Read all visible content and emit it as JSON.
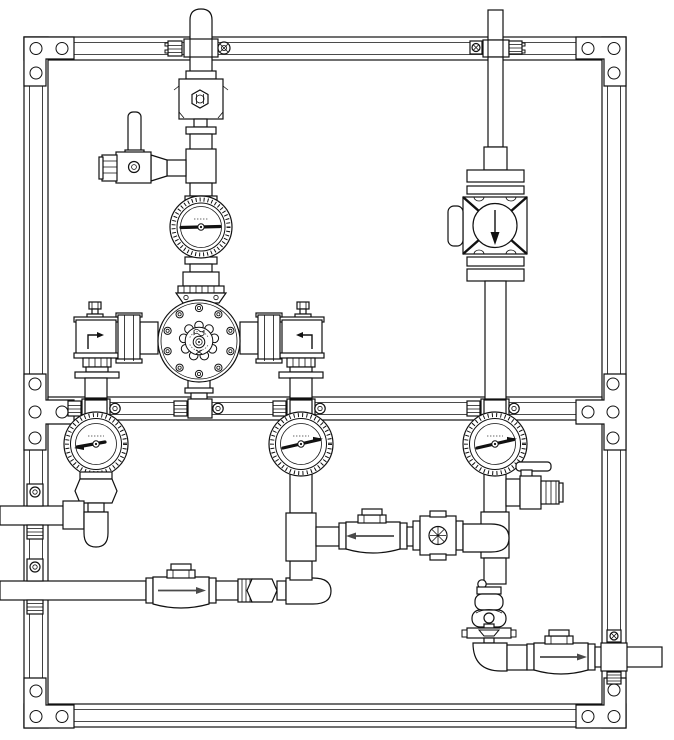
{
  "meta": {
    "title": "Piping assembly technical drawing (mixing valve station)",
    "canvas_width": 674,
    "canvas_height": 740
  },
  "style": {
    "background": "#ffffff",
    "line_color": "#111111",
    "flow_arrow_color": "#4a4a4a",
    "microtext_color": "#666666"
  },
  "frame": {
    "label": "Extruded aluminum mounting frame",
    "rails": [
      "top",
      "bottom",
      "left",
      "right",
      "middle"
    ],
    "corner_plates": [
      "top-left",
      "top-right",
      "bottom-left",
      "bottom-right"
    ],
    "junction_plates": [
      "middle-left",
      "middle-right"
    ],
    "holes_per_corner_plate": 3,
    "holes_per_junction_plate": 4
  },
  "components": {
    "left_riser": {
      "label": "Left inlet riser pipe (domed top, exits frame top)"
    },
    "relief_valve": {
      "label": "Pressure relief / reducing valve with hex bonnet"
    },
    "left_drain": {
      "label": "Test drain ball valve with lever handle and hose cap"
    },
    "thermometer": {
      "label": "Inline dial thermometer"
    },
    "regulator": {
      "label": "Round diaphragm regulator / thermostatic mixing valve with bolted flange and scalloped handwheel"
    },
    "left_angle_valve": {
      "label": "Left angle stop valve, flow arrow up-then-right"
    },
    "right_angle_valve": {
      "label": "Right angle stop valve, flow arrow up-then-left"
    },
    "union_left": {
      "label": "Pipe union, left of regulator"
    },
    "union_right": {
      "label": "Pipe union, right of regulator"
    },
    "right_riser": {
      "label": "Right riser pipe (exits frame top)"
    },
    "vertical_check": {
      "label": "Vertical check valve, flow arrow down"
    },
    "gauge_left": {
      "label": "Left pressure gauge"
    },
    "gauge_middle": {
      "label": "Middle pressure gauge"
    },
    "gauge_right": {
      "label": "Right pressure gauge"
    },
    "hex_fitting": {
      "label": "Hex adapter fitting below left gauge"
    },
    "left_upper_outlet": {
      "label": "Upper-left horizontal pipe, exits frame left"
    },
    "left_lower_inlet": {
      "label": "Lower-left horizontal pipe, exits frame left"
    },
    "check_lower_left": {
      "label": "Swing check valve, flow arrow right"
    },
    "hex_union": {
      "label": "Hex union on lower-left run"
    },
    "check_mid": {
      "label": "Swing check valve, flow arrow left"
    },
    "ball_valve": {
      "label": "Ball valve with cross-hatched port"
    },
    "right_drain": {
      "label": "Drain ball valve with lever handle and hose cap"
    },
    "vacuum_breaker": {
      "label": "Vacuum breaker / relief fitting stack"
    },
    "check_bottom_right": {
      "label": "Swing check valve, flow arrow right"
    },
    "bottom_outlet": {
      "label": "Bottom-right horizontal pipe, exits frame right"
    },
    "pipe_clamp": {
      "label": "Pipe-to-rail clamp with screw and ribbed block"
    }
  },
  "flow_arrows": [
    {
      "location": "left-angle-valve",
      "direction": "up-then-right"
    },
    {
      "location": "right-angle-valve",
      "direction": "up-then-left"
    },
    {
      "location": "vertical-check-valve",
      "direction": "down"
    },
    {
      "location": "lower-left-run",
      "direction": "right"
    },
    {
      "location": "middle-cross-run",
      "direction": "left"
    },
    {
      "location": "bottom-right-run",
      "direction": "right"
    }
  ],
  "gauges": [
    {
      "id": "inline-thermometer",
      "needle_direction": "left-horizontal"
    },
    {
      "id": "gauge-left",
      "needle_direction": "left-slightly-down"
    },
    {
      "id": "gauge-middle",
      "needle_direction": "right-slightly-up"
    },
    {
      "id": "gauge-right",
      "needle_direction": "right-slightly-up"
    }
  ]
}
